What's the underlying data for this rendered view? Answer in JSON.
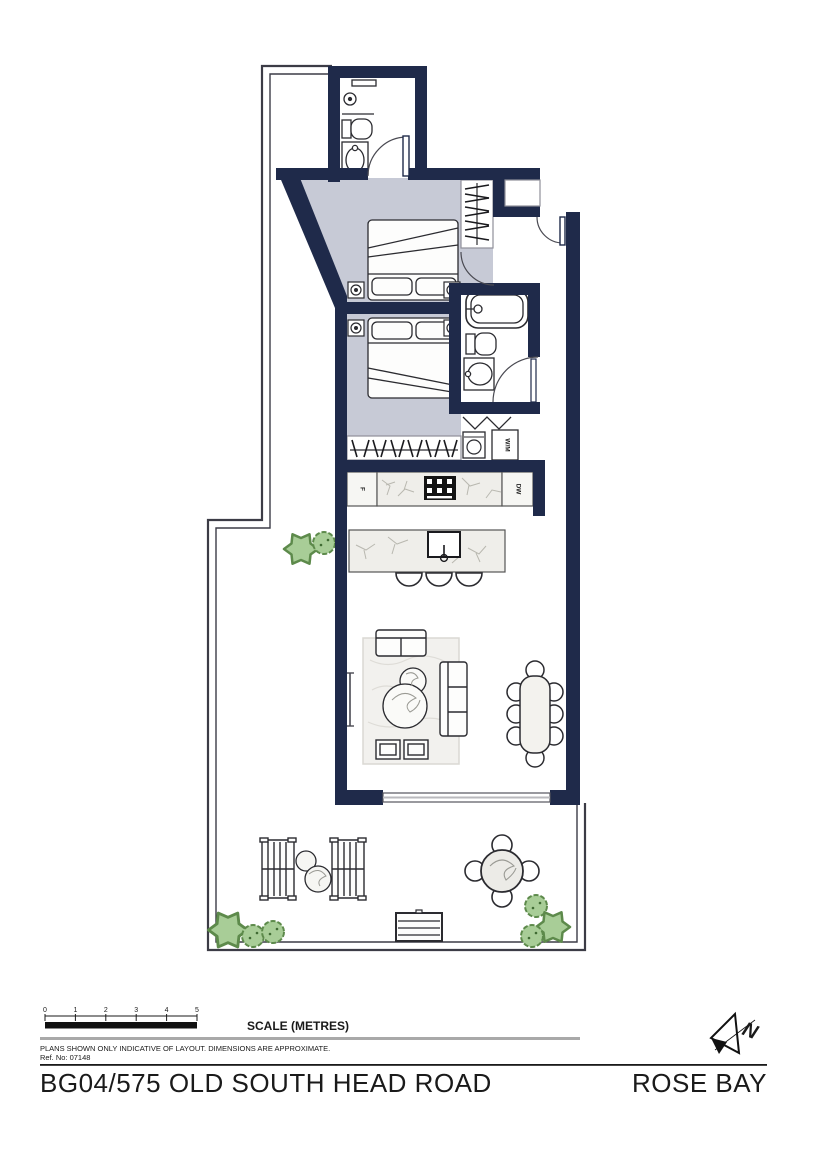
{
  "plan": {
    "colors": {
      "wall": "#1f2a4a",
      "bedroom_floor": "#c7cad6",
      "stone": "#efeeea",
      "plant": "#a8cd97",
      "plant_edge": "#5d8a4b",
      "outline": "#3c3c46"
    },
    "labels": {
      "fridge": "F",
      "dishwasher": "DW",
      "washer": "W/M"
    },
    "compass": {
      "letter": "N"
    },
    "footer": {
      "scale_label": "SCALE (METRES)",
      "scale_marks": [
        "0",
        "1",
        "2",
        "3",
        "4",
        "5"
      ],
      "disclaimer": "PLANS SHOWN ONLY INDICATIVE OF LAYOUT.  DIMENSIONS ARE APPROXIMATE.",
      "ref_no": "Ref. No: 07148",
      "address": "BG04/575 OLD SOUTH HEAD ROAD",
      "suburb": "ROSE BAY"
    }
  }
}
